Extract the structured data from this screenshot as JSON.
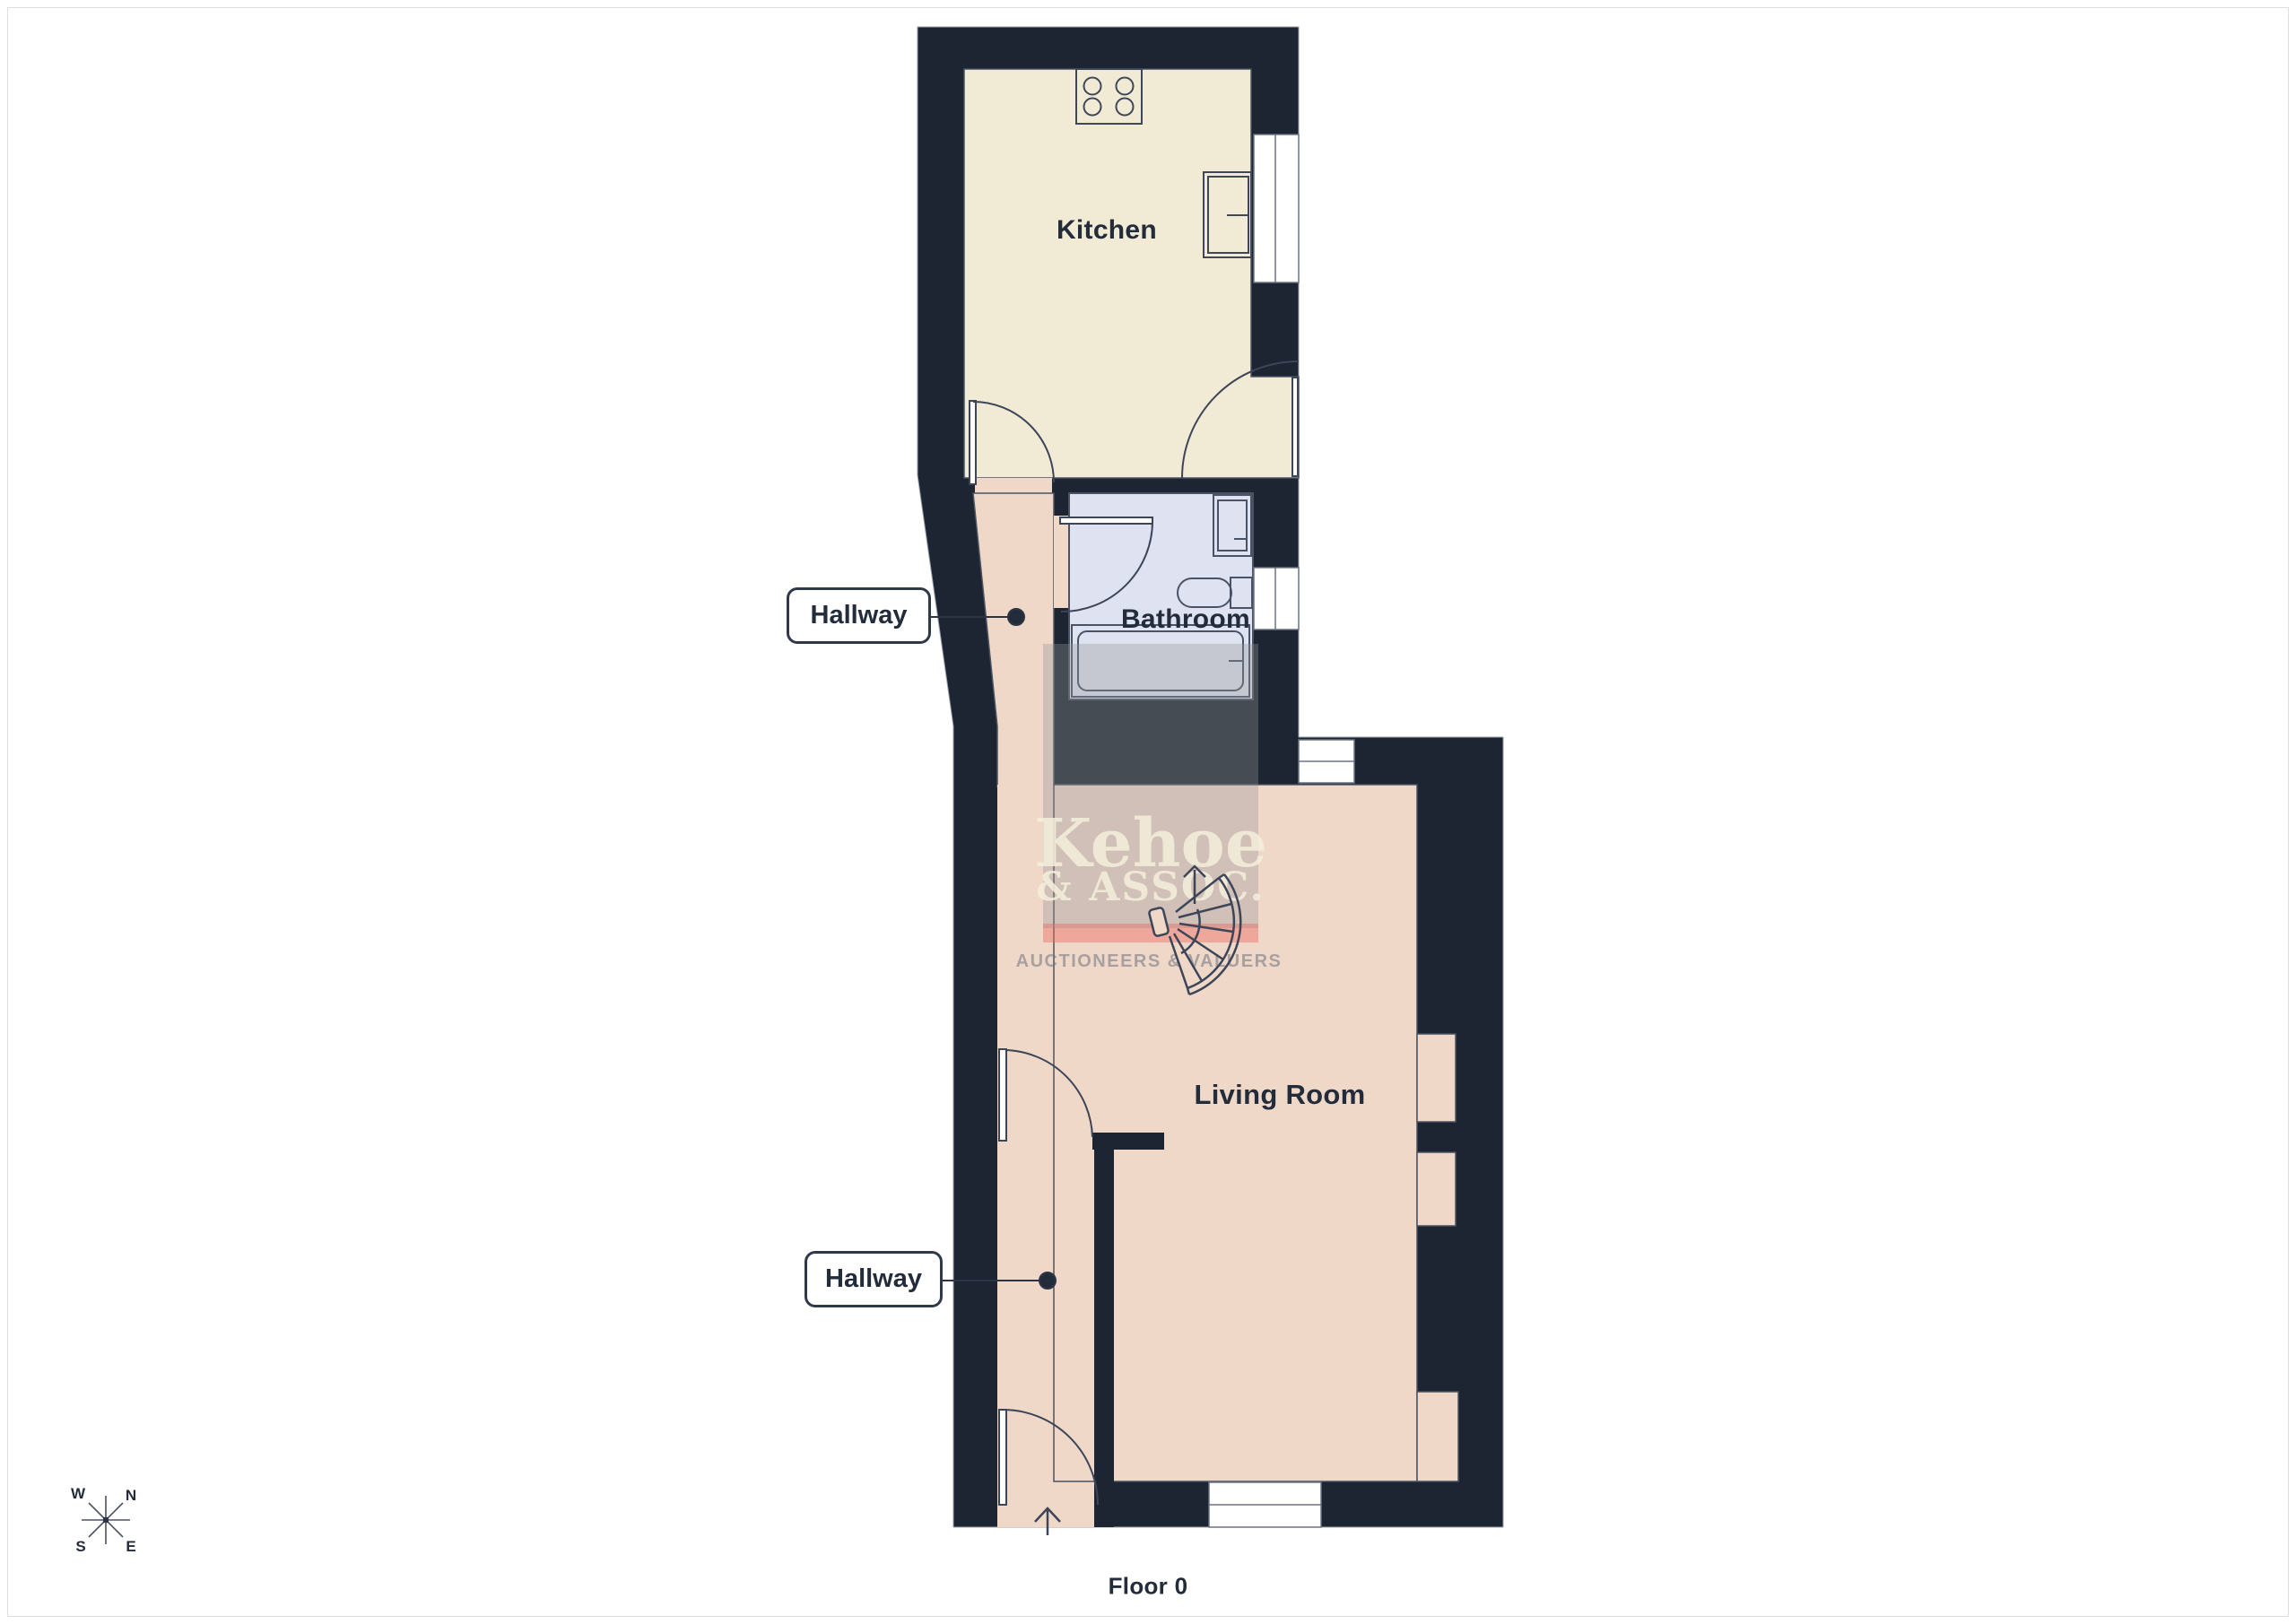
{
  "page": {
    "floor_label": "Floor 0"
  },
  "rooms": {
    "kitchen": "Kitchen",
    "bathroom": "Bathroom",
    "living_room": "Living Room",
    "hallway_upper": "Hallway",
    "hallway_lower": "Hallway"
  },
  "compass": {
    "north": "N",
    "south": "S",
    "east": "E",
    "west": "W"
  },
  "watermark": {
    "name": "Kehoe",
    "subtitle": "& ASSOC.",
    "tagline": "AUCTIONEERS & VALUERS"
  },
  "icons": {
    "stairs": "winder-staircase-fan",
    "compass": "eight-point-compass-rose",
    "entrance": "up-arrow",
    "stove": "four-burner-hob"
  },
  "colors": {
    "wall": "#1c2531",
    "kitchen_floor": "#f1ead5",
    "hall_floor": "#f0d8c9",
    "bathroom_floor": "#dfe3f1",
    "outline": "#434b5c",
    "label_ink": "#232c3b",
    "watermark_band": "#e96c64"
  }
}
